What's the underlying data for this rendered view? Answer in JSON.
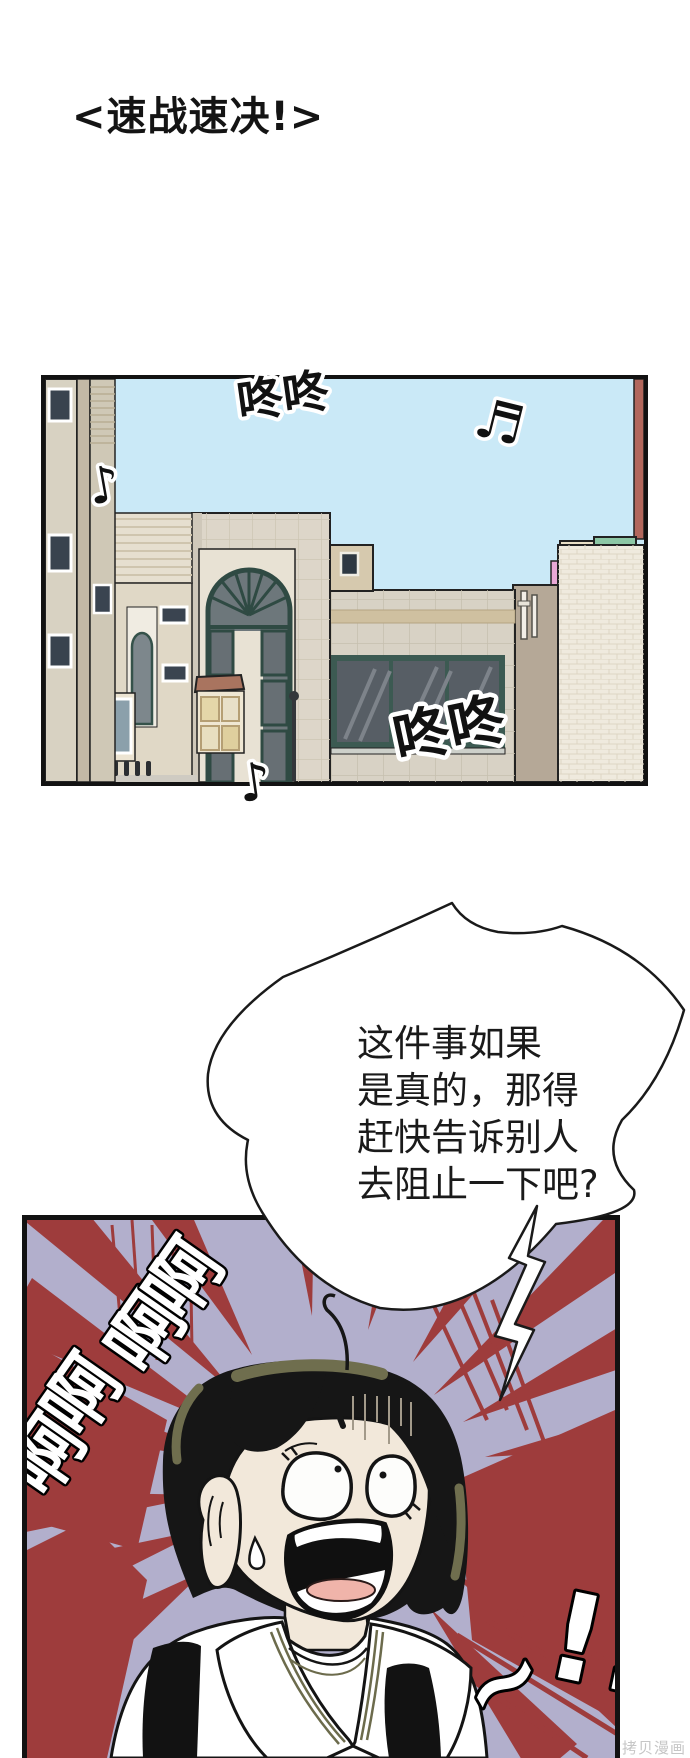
{
  "page": {
    "title": "<速战速决!>",
    "watermark": "拷贝漫画",
    "background_color": "#ffffff"
  },
  "panel1": {
    "description": "street-buildings-scene",
    "sfx_knock_top": "咚咚",
    "sfx_knock_bottom": "咚咚",
    "sfx_note_right": "♬",
    "sfx_note_left": "♪",
    "sfx_note_bottom": "♪",
    "colors": {
      "sky": "#cae9f7",
      "building_tan": "#ddd6c9",
      "window_frame_teal": "#2f4a43",
      "window_glass": "#575e65",
      "mint_roof": "#8cc7a5",
      "brick_red": "#b2675c",
      "pink_wall": "#e9a8d6"
    }
  },
  "speech_bubble": {
    "lines": [
      "这件事如果",
      "是真的，那得",
      "赶快告诉别人",
      "去阻止一下吧?"
    ]
  },
  "panel2": {
    "description": "screaming-girl-scene",
    "sfx_scream_char": "啊",
    "sfx_scream_count": 4,
    "sfx_tilde": "~",
    "sfx_exclaim": "!!",
    "colors": {
      "background_lavender": "#b2afcc",
      "burst_red": "#9e3c3c",
      "hair_black": "#161616",
      "hair_highlight_olive": "#6f6e4e",
      "skin": "#f2e8da",
      "tongue_pink": "#f0b4aa",
      "collar_trim_olive": "#6c6b4c"
    }
  }
}
